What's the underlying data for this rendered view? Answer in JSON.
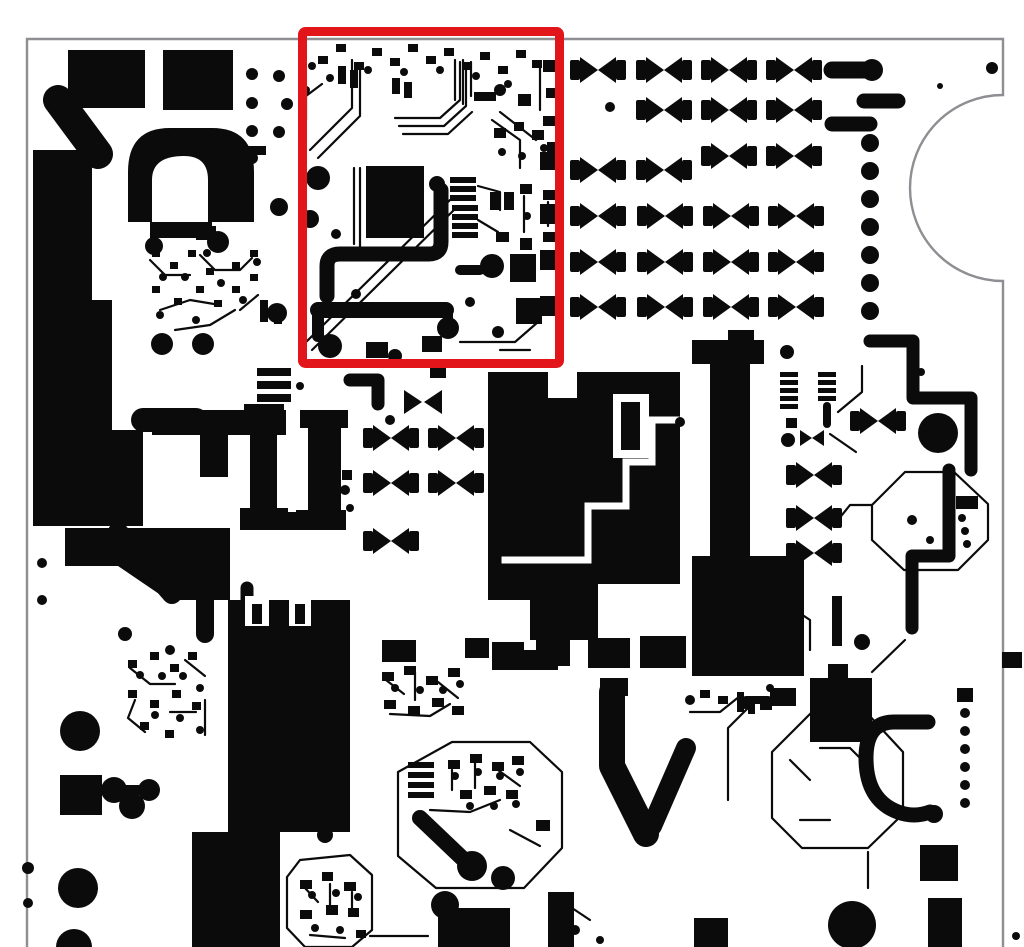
{
  "meta": {
    "description": "Monochrome printed circuit board copper-layer artwork (black traces and pads on white) with a red rectangle annotation highlighting one circuit block in the upper middle area"
  },
  "colors": {
    "page": "#fafafa",
    "board": "#ffffff",
    "copper": "#0b0b0b",
    "outline": "#8e8e93",
    "highlight": "#e2151b"
  },
  "board_outline": {
    "left": 27,
    "top": 39,
    "right": 1003,
    "bottom": 947,
    "notch_top_y": 95,
    "notch_bottom_y": 281,
    "notch_radius": 93
  },
  "highlight": {
    "x": 298,
    "y": 27,
    "width": 266,
    "height": 341,
    "stroke_width": 9
  },
  "led_array": {
    "pair_width": 56,
    "pair_height": 26,
    "rows": [
      {
        "y": 57,
        "xs": [
          570,
          636,
          701,
          766
        ]
      },
      {
        "y": 97,
        "xs": [
          636,
          701,
          766
        ]
      },
      {
        "y": 143,
        "xs": [
          701,
          766
        ]
      },
      {
        "y": 157,
        "xs": [
          570,
          636
        ]
      },
      {
        "y": 203,
        "xs": [
          570,
          637,
          703,
          768
        ]
      },
      {
        "y": 249,
        "xs": [
          570,
          637,
          703,
          768
        ]
      },
      {
        "y": 294,
        "xs": [
          570,
          637,
          703,
          768
        ]
      }
    ]
  },
  "mid_pairs": {
    "rows": [
      {
        "y": 425,
        "xs": [
          363,
          428
        ]
      },
      {
        "y": 470,
        "xs": [
          363,
          428
        ]
      },
      {
        "y": 528,
        "xs": [
          363
        ]
      },
      {
        "y": 462,
        "xs": [
          786
        ]
      },
      {
        "y": 505,
        "xs": [
          786
        ]
      },
      {
        "y": 540,
        "xs": [
          786
        ]
      },
      {
        "y": 408,
        "xs": [
          850
        ]
      }
    ]
  },
  "via_column": {
    "x": 870,
    "r": 9,
    "ys": [
      143,
      171,
      199,
      227,
      255,
      283,
      311
    ]
  },
  "right_dot_column": {
    "x": 965,
    "r": 5,
    "ys": [
      695,
      713,
      731,
      749,
      767,
      785,
      803
    ]
  }
}
